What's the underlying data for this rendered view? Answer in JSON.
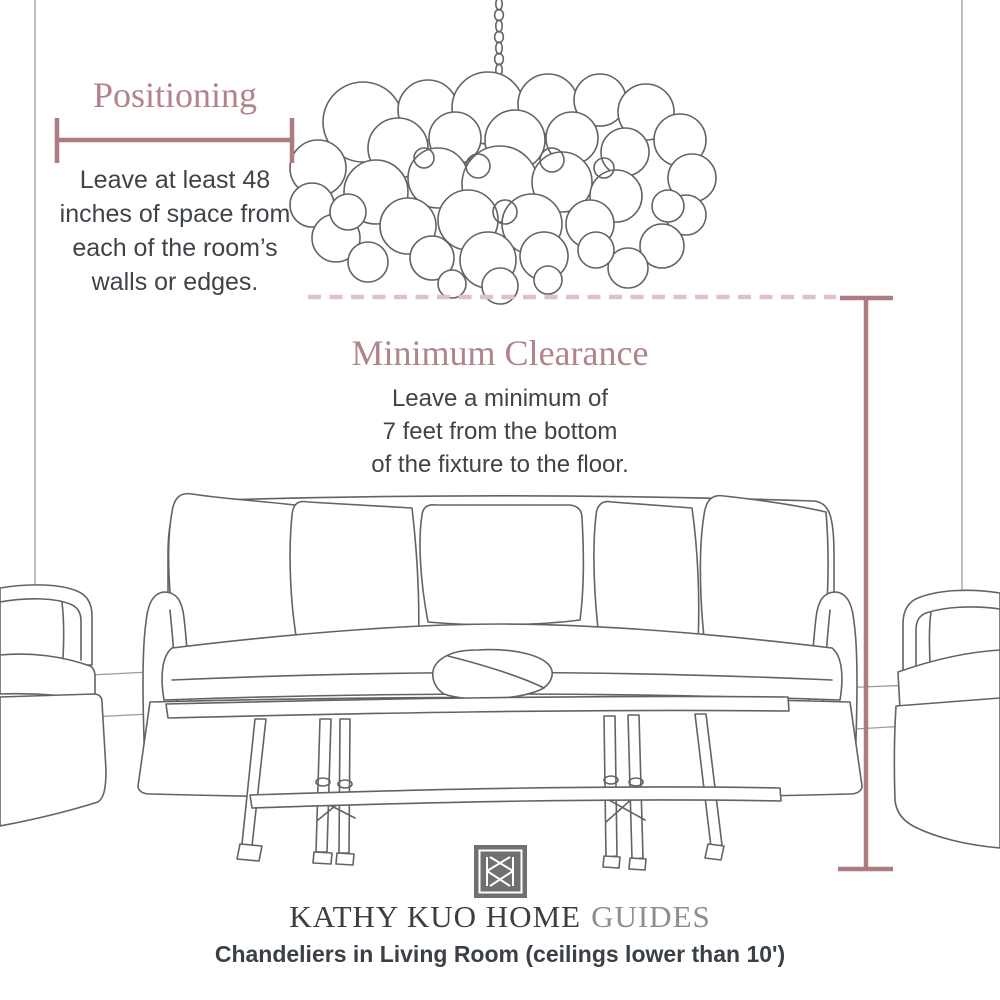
{
  "palette": {
    "accent_line": "#ad7c82",
    "dashed_line": "#dcc2c8",
    "heading_rose": "#b28389",
    "body_text": "#3f4449",
    "sketch_gray": "#636363",
    "logo_gray": "#707070",
    "brand_dark": "#3e3e40",
    "brand_light": "#8e8e90"
  },
  "positioning": {
    "title": "Positioning",
    "lines": [
      "Leave at least 48",
      "inches of space from",
      "each of the room’s",
      "walls or edges."
    ]
  },
  "clearance": {
    "title": "Minimum Clearance",
    "lines": [
      "Leave a minimum of",
      "7 feet from the bottom",
      "of the fixture to the floor."
    ]
  },
  "footer": {
    "brand": "KATHY KUO HOME",
    "brand_suffix": "GUIDES",
    "caption": "Chandeliers in Living Room (ceilings lower than 10')"
  },
  "icons": {
    "brand_monogram": "double-k-monogram"
  }
}
